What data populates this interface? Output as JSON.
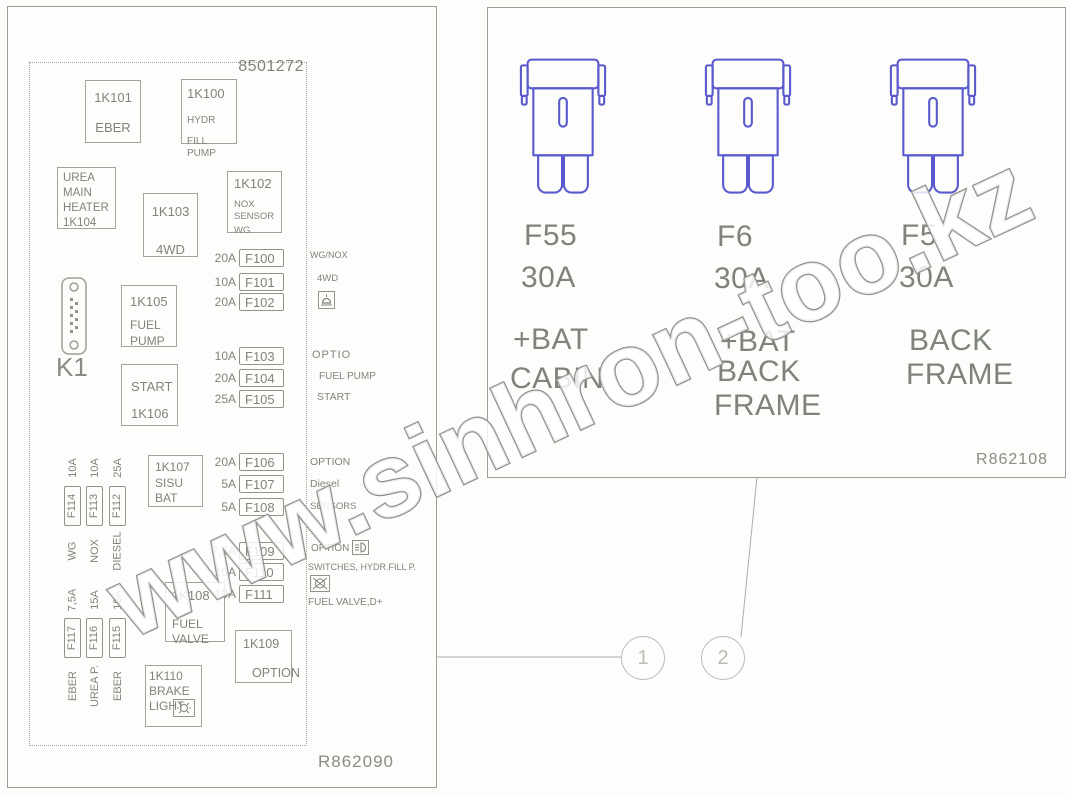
{
  "watermark_text": "www.sinhron-too.kz",
  "colors": {
    "line": "#9aa098",
    "text": "#7f847c",
    "fuse_symbol": "#5a5ace",
    "watermark_outline": "#8e948d",
    "callout": "#b7bcb6"
  },
  "icons": {
    "f102_row": "beacon-icon",
    "f109_row": "worklight-icon",
    "f110_row": "hydraulic-pump-icon",
    "relay_1k110": "brake-lamp-icon",
    "k1": "dsub-connector-icon",
    "right_panel_fuse": "maxi-fuse-icon"
  },
  "left": {
    "part_number": "8501272",
    "drawing_ref": "R862090",
    "k1_label": "K1",
    "relays": [
      {
        "lines": [
          "1K101",
          "EBER"
        ]
      },
      {
        "lines": [
          "1K100",
          "HYDR",
          "FILL PUMP"
        ]
      },
      {
        "lines": [
          "UREA",
          "MAIN",
          "HEATER",
          "1K104"
        ]
      },
      {
        "lines": [
          "1K103",
          "4WD"
        ]
      },
      {
        "lines": [
          "1K102",
          "NOX",
          "SENSOR",
          "WG"
        ]
      },
      {
        "lines": [
          "1K105",
          "FUEL",
          "PUMP"
        ]
      },
      {
        "lines": [
          "START",
          "1K106"
        ]
      },
      {
        "lines": [
          "1K107",
          "SISU",
          "BAT"
        ]
      },
      {
        "lines": [
          "1K108",
          "FUEL",
          "VALVE"
        ]
      },
      {
        "lines": [
          "1K109",
          "OPTION"
        ]
      },
      {
        "lines": [
          "1K110",
          "BRAKE",
          "LIGHT"
        ]
      }
    ],
    "fuse_rows": [
      {
        "amp": "20A",
        "id": "F100"
      },
      {
        "amp": "10A",
        "id": "F101"
      },
      {
        "amp": "20A",
        "id": "F102"
      },
      {
        "amp": "10A",
        "id": "F103"
      },
      {
        "amp": "20A",
        "id": "F104"
      },
      {
        "amp": "25A",
        "id": "F105"
      },
      {
        "amp": "20A",
        "id": "F106"
      },
      {
        "amp": "5A",
        "id": "F107"
      },
      {
        "amp": "5A",
        "id": "F108"
      },
      {
        "amp": "7,5A",
        "id": "F109"
      },
      {
        "amp": "10A",
        "id": "F110"
      },
      {
        "amp": "10A",
        "id": "F111"
      }
    ],
    "row_labels": [
      "WG/NOX",
      "4WD",
      "OPTIO",
      "FUEL PUMP",
      "START",
      "OPTION",
      "Diesel",
      "SENSORS",
      "OPTION",
      "SWITCHES, HYDR.FILL P.",
      "FUEL VALVE,D+"
    ],
    "side_fuses_top": [
      {
        "amp": "10A",
        "id": "F114",
        "label": "WG"
      },
      {
        "amp": "10A",
        "id": "F113",
        "label": "NOX"
      },
      {
        "amp": "25A",
        "id": "F112",
        "label": "DIESEL"
      }
    ],
    "side_fuses_bottom": [
      {
        "amp": "7,5A",
        "id": "F117",
        "label": "EBER"
      },
      {
        "amp": "15A",
        "id": "F116",
        "label": "UREA P."
      },
      {
        "amp": "15A",
        "id": "F115",
        "label": "EBER"
      }
    ]
  },
  "right": {
    "drawing_ref": "R862108",
    "fuses": [
      {
        "id": "F55",
        "amp": "30A",
        "lines": [
          "+BAT",
          "CABIN"
        ]
      },
      {
        "id": "F6",
        "amp": "30A",
        "lines": [
          "+BAT",
          "BACK",
          "FRAME"
        ]
      },
      {
        "id": "F5",
        "amp": "30A",
        "lines": [
          "BACK",
          "FRAME"
        ]
      }
    ]
  },
  "callouts": [
    "1",
    "2"
  ]
}
